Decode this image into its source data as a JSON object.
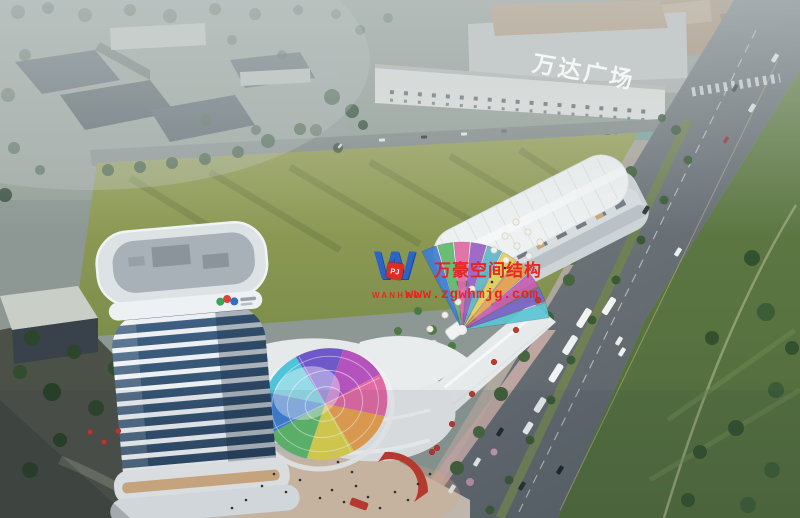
{
  "signage": {
    "wanda_plaza_sign": "万达广场"
  },
  "watermark": {
    "logo_letter": "W",
    "logo_badge": "PJ",
    "brand_latin": "WANHAO",
    "brand_cn": "万豪空间结构",
    "url": "www.zgwhmjg.com",
    "text_color": "#e8231d",
    "logo_blue": "#2a62cc"
  },
  "palette": {
    "haze": "#c7cecf",
    "field_green": "#8a9a52",
    "lawn_green": "#5e7a44",
    "road_gray": "#70787d",
    "building_white": "#eceff0",
    "glass_blue": "#31506e",
    "accent_red": "#c23a2c",
    "plaza_warm": "#cdc2b6"
  },
  "tower_logo_colors": [
    "#3aa558",
    "#d94436",
    "#2f6fc4"
  ],
  "scene": {
    "dome": {
      "cx": 325,
      "cy": 404,
      "rx": 63,
      "ry": 55,
      "rot": -18,
      "start": 168,
      "step": 45,
      "colors": [
        "#3f7fd4",
        "#4fc3d9",
        "#6f58c9",
        "#b553bd",
        "#e06aa3",
        "#e8a14e",
        "#ddd24e",
        "#5fb96a"
      ]
    },
    "fan": {
      "cx": 462,
      "cy": 330,
      "r": 88,
      "start": -8,
      "step": -11,
      "colors": [
        "#59c6d6",
        "#7a68cc",
        "#c75fb4",
        "#e8a14e",
        "#e3d25a",
        "#62b7c9",
        "#9a5fc4",
        "#e06aa3",
        "#5fb96a",
        "#3f7fd4"
      ]
    },
    "trees": [
      [
        18,
        12,
        7,
        "#3f5742",
        0.65
      ],
      [
        48,
        8,
        6,
        "#35503c",
        0.65
      ],
      [
        85,
        15,
        7,
        "#3f5742",
        0.65
      ],
      [
        130,
        10,
        6,
        "#35503c",
        0.65
      ],
      [
        170,
        16,
        7,
        "#3f5742",
        0.65
      ],
      [
        215,
        9,
        6,
        "#35503c",
        0.65
      ],
      [
        255,
        14,
        6,
        "#3f5742",
        0.65
      ],
      [
        298,
        10,
        5,
        "#35503c",
        0.65
      ],
      [
        336,
        14,
        5,
        "#3f5742",
        0.6
      ],
      [
        360,
        30,
        5,
        "#35503c",
        0.55
      ],
      [
        388,
        18,
        5,
        "#3f5742",
        0.5
      ],
      [
        25,
        55,
        6,
        "#35503c",
        0.6
      ],
      [
        8,
        95,
        7,
        "#3f5742",
        0.6
      ],
      [
        14,
        148,
        6,
        "#35503c",
        0.7
      ],
      [
        5,
        195,
        7,
        "#2f4a34",
        0.8
      ],
      [
        40,
        170,
        5,
        "#35503c",
        0.7
      ],
      [
        232,
        40,
        5,
        "#3f5742",
        0.6
      ],
      [
        282,
        55,
        5,
        "#35503c",
        0.6
      ],
      [
        206,
        120,
        6,
        "#3f5742",
        0.7
      ],
      [
        256,
        130,
        5,
        "#35503c",
        0.7
      ],
      [
        316,
        130,
        6,
        "#3f5742",
        0.7
      ],
      [
        338,
        148,
        5,
        "#35503c",
        0.75
      ],
      [
        108,
        170,
        6,
        "#3b583b",
        0.9
      ],
      [
        140,
        167,
        6,
        "#3b583b",
        0.9
      ],
      [
        172,
        163,
        6,
        "#3b583b",
        0.9
      ],
      [
        205,
        159,
        6,
        "#3b583b",
        0.9
      ],
      [
        238,
        152,
        6,
        "#3b583b",
        0.9
      ],
      [
        268,
        141,
        7,
        "#3b583b",
        0.9
      ],
      [
        300,
        129,
        6,
        "#3b583b",
        0.9
      ],
      [
        332,
        97,
        8,
        "#35523a",
        0.95
      ],
      [
        352,
        111,
        7,
        "#35523a",
        0.95
      ],
      [
        363,
        125,
        5,
        "#35523a",
        0.95
      ],
      [
        676,
        130,
        5,
        "#3b583b",
        0.9
      ],
      [
        662,
        118,
        4,
        "#3b583b",
        0.9
      ],
      [
        631,
        172,
        6,
        "#40603a",
        1
      ],
      [
        614,
        205,
        6,
        "#47663f",
        1
      ],
      [
        592,
        242,
        7,
        "#40603a",
        1
      ],
      [
        569,
        280,
        6,
        "#47663f",
        1
      ],
      [
        547,
        318,
        7,
        "#40603a",
        1
      ],
      [
        524,
        356,
        6,
        "#47663f",
        1
      ],
      [
        501,
        394,
        7,
        "#40603a",
        1
      ],
      [
        479,
        432,
        6,
        "#47663f",
        1
      ],
      [
        457,
        468,
        7,
        "#40603a",
        1
      ],
      [
        440,
        498,
        6,
        "#47663f",
        1
      ],
      [
        688,
        160,
        4.5,
        "#3a5a36",
        1
      ],
      [
        664,
        200,
        4.5,
        "#3a5a36",
        1
      ],
      [
        641,
        240,
        4.5,
        "#3a5a36",
        1
      ],
      [
        616,
        280,
        4.5,
        "#3a5a36",
        1
      ],
      [
        592,
        320,
        4.5,
        "#3a5a36",
        1
      ],
      [
        571,
        360,
        4.5,
        "#3a5a36",
        1
      ],
      [
        551,
        400,
        4.5,
        "#3a5a36",
        1
      ],
      [
        530,
        440,
        4.5,
        "#3a5a36",
        1
      ],
      [
        509,
        480,
        4.5,
        "#3a5a36",
        1
      ],
      [
        490,
        510,
        4.5,
        "#3a5a36",
        1
      ],
      [
        752,
        258,
        8,
        "#32512f",
        1
      ],
      [
        766,
        312,
        9,
        "#3b5c36",
        1
      ],
      [
        712,
        338,
        7,
        "#32512f",
        1
      ],
      [
        776,
        390,
        8,
        "#3b5c36",
        1
      ],
      [
        736,
        428,
        8,
        "#32512f",
        1
      ],
      [
        772,
        470,
        8,
        "#3b5c36",
        1
      ],
      [
        700,
        452,
        7,
        "#32512f",
        1
      ],
      [
        748,
        505,
        8,
        "#3b5c36",
        1
      ],
      [
        688,
        500,
        7,
        "#32512f",
        1
      ],
      [
        792,
        348,
        7,
        "#32512f",
        1
      ],
      [
        32,
        338,
        8,
        "#2c452b",
        1
      ],
      [
        74,
        352,
        7,
        "#2c452b",
        1
      ],
      [
        116,
        368,
        8,
        "#314c2e",
        1
      ],
      [
        154,
        386,
        7,
        "#2c452b",
        1
      ],
      [
        52,
        392,
        9,
        "#273f28",
        1
      ],
      [
        96,
        408,
        8,
        "#2c452b",
        1
      ],
      [
        20,
        372,
        7,
        "#314c2e",
        1
      ],
      [
        140,
        418,
        6,
        "#2c452b",
        1
      ],
      [
        182,
        402,
        5,
        "#314c2e",
        1
      ],
      [
        60,
        440,
        7,
        "#273f28",
        1
      ],
      [
        30,
        470,
        8,
        "#2c452b",
        1
      ],
      [
        540,
        232,
        5,
        "#4c7a44",
        1
      ],
      [
        556,
        246,
        5,
        "#4c7a44",
        1
      ],
      [
        572,
        260,
        5,
        "#4c7a44",
        1
      ],
      [
        432,
        330,
        5,
        "#4c7a44",
        1
      ],
      [
        452,
        346,
        4,
        "#4c7a44",
        1
      ],
      [
        412,
        362,
        5,
        "#4c7a44",
        1
      ],
      [
        372,
        392,
        5,
        "#4c7a44",
        1
      ],
      [
        340,
        370,
        4,
        "#4c7a44",
        1
      ],
      [
        398,
        331,
        4,
        "#4c7a44",
        1
      ],
      [
        418,
        311,
        4,
        "#4c7a44",
        1
      ],
      [
        330,
        430,
        5,
        "#4c7a44",
        1
      ],
      [
        360,
        448,
        4,
        "#4c7a44",
        1
      ],
      [
        300,
        350,
        4,
        "#4c7a44",
        1
      ],
      [
        282,
        368,
        4,
        "#4c7a44",
        1
      ],
      [
        160,
        422,
        5,
        "#a87fad",
        1
      ],
      [
        124,
        442,
        4,
        "#b890bb",
        1
      ],
      [
        470,
        482,
        4,
        "#b98fa6",
        1
      ],
      [
        494,
        452,
        3.5,
        "#c49ab2",
        1
      ],
      [
        214,
        468,
        4,
        "#b088b0",
        1
      ]
    ],
    "vehicles": [
      [
        584,
        318,
        21,
        7,
        -58,
        "#f2f4f3"
      ],
      [
        570,
        345,
        21,
        7,
        -58,
        "#eef1f1"
      ],
      [
        556,
        373,
        20,
        7,
        -58,
        "#f2f4f3"
      ],
      [
        540,
        405,
        16,
        6.5,
        -58,
        "#eceeee"
      ],
      [
        528,
        428,
        13,
        6,
        -58,
        "#f0f2f2"
      ],
      [
        609,
        306,
        19,
        6.5,
        -58,
        "#f2f4f3"
      ],
      [
        619,
        341,
        9,
        4.5,
        -58,
        "#e9eceb"
      ],
      [
        477,
        462,
        9,
        4.5,
        -58,
        "#eef0ef"
      ],
      [
        452,
        489,
        9,
        4.5,
        -58,
        "#e6e9e8"
      ],
      [
        678,
        252,
        9,
        4.5,
        -58,
        "#edefee"
      ],
      [
        622,
        352,
        9,
        4.5,
        -58,
        "#f0f2f1"
      ],
      [
        775,
        58,
        9,
        4.5,
        -58,
        "#e9eceb"
      ],
      [
        752,
        108,
        9,
        4.5,
        -58,
        "#dfe3e2"
      ],
      [
        500,
        432,
        9,
        4.5,
        -58,
        "#25292d"
      ],
      [
        522,
        486,
        9,
        4.5,
        -58,
        "#2a2e32"
      ],
      [
        646,
        210,
        9,
        4.5,
        -58,
        "#303438"
      ],
      [
        735,
        88,
        8,
        4,
        -58,
        "#3a3f43"
      ],
      [
        560,
        470,
        9,
        4.5,
        -58,
        "#202428"
      ],
      [
        726,
        140,
        7,
        3.5,
        -58,
        "#8e3430"
      ],
      [
        382,
        140,
        6,
        3,
        -4,
        "#e8eaea"
      ],
      [
        424,
        137,
        6,
        3,
        -4,
        "#35383c"
      ],
      [
        464,
        134,
        6,
        3,
        -4,
        "#e8eaea"
      ],
      [
        504,
        131,
        6,
        3,
        -4,
        "#6a6f74"
      ],
      [
        340,
        146,
        5,
        2.5,
        -50,
        "#d8dada"
      ]
    ],
    "umbrellas_white": [
      [
        516,
        222
      ],
      [
        528,
        232
      ],
      [
        540,
        242
      ],
      [
        505,
        236
      ],
      [
        517,
        246
      ],
      [
        529,
        256
      ],
      [
        494,
        250
      ],
      [
        506,
        260
      ],
      [
        445,
        315
      ],
      [
        458,
        302
      ],
      [
        472,
        289
      ],
      [
        430,
        329
      ]
    ],
    "umbrellas_red": [
      [
        538,
        300
      ],
      [
        516,
        330
      ],
      [
        494,
        362
      ],
      [
        472,
        394
      ],
      [
        452,
        424
      ],
      [
        432,
        452
      ],
      [
        90,
        432
      ],
      [
        104,
        442
      ],
      [
        118,
        431
      ],
      [
        437,
        448
      ]
    ],
    "people": [
      [
        320,
        498
      ],
      [
        332,
        490
      ],
      [
        344,
        502
      ],
      [
        356,
        486
      ],
      [
        368,
        497
      ],
      [
        380,
        508
      ],
      [
        395,
        492
      ],
      [
        408,
        500
      ],
      [
        300,
        480
      ],
      [
        286,
        492
      ],
      [
        418,
        484
      ],
      [
        430,
        474
      ],
      [
        352,
        472
      ],
      [
        338,
        462
      ],
      [
        232,
        508
      ],
      [
        246,
        500
      ],
      [
        505,
        268
      ],
      [
        492,
        282
      ],
      [
        262,
        486
      ],
      [
        274,
        474
      ]
    ]
  }
}
